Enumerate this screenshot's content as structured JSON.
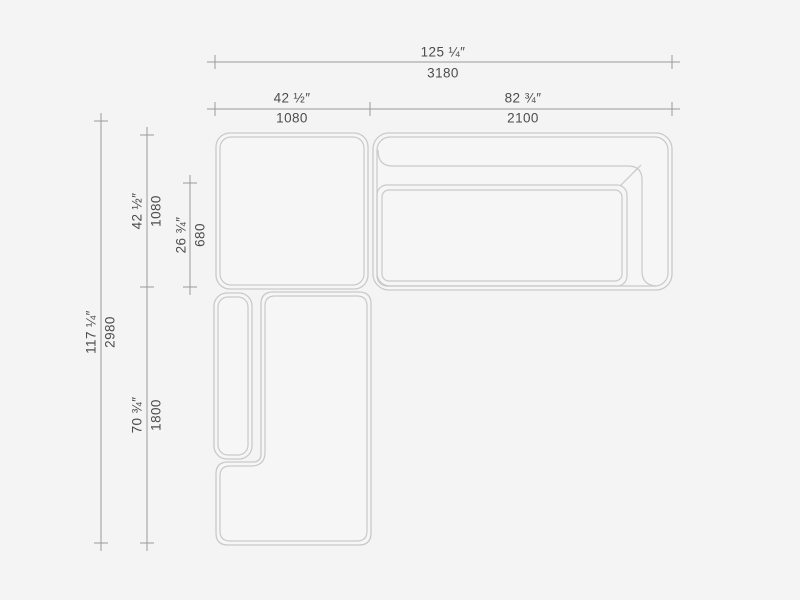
{
  "colors": {
    "background": "#f4f4f4",
    "furniture_fill": "#f6f6f6",
    "furniture_line": "#c9c9c9",
    "dimension_line": "#9a9a9a",
    "label_text": "#4d4d4d"
  },
  "dimensions": {
    "overall_width": {
      "inches": "125 ¼″",
      "mm": "3180"
    },
    "left_module_width": {
      "inches": "42 ½″",
      "mm": "1080"
    },
    "sofa_width": {
      "inches": "82 ¾″",
      "mm": "2100"
    },
    "overall_depth": {
      "inches": "117 ¼″",
      "mm": "2980"
    },
    "left_module_depth": {
      "inches": "42 ½″",
      "mm": "1080"
    },
    "seat_depth": {
      "inches": "26 ¾″",
      "mm": "680"
    },
    "chaise_length": {
      "inches": "70 ¾″",
      "mm": "1800"
    }
  }
}
